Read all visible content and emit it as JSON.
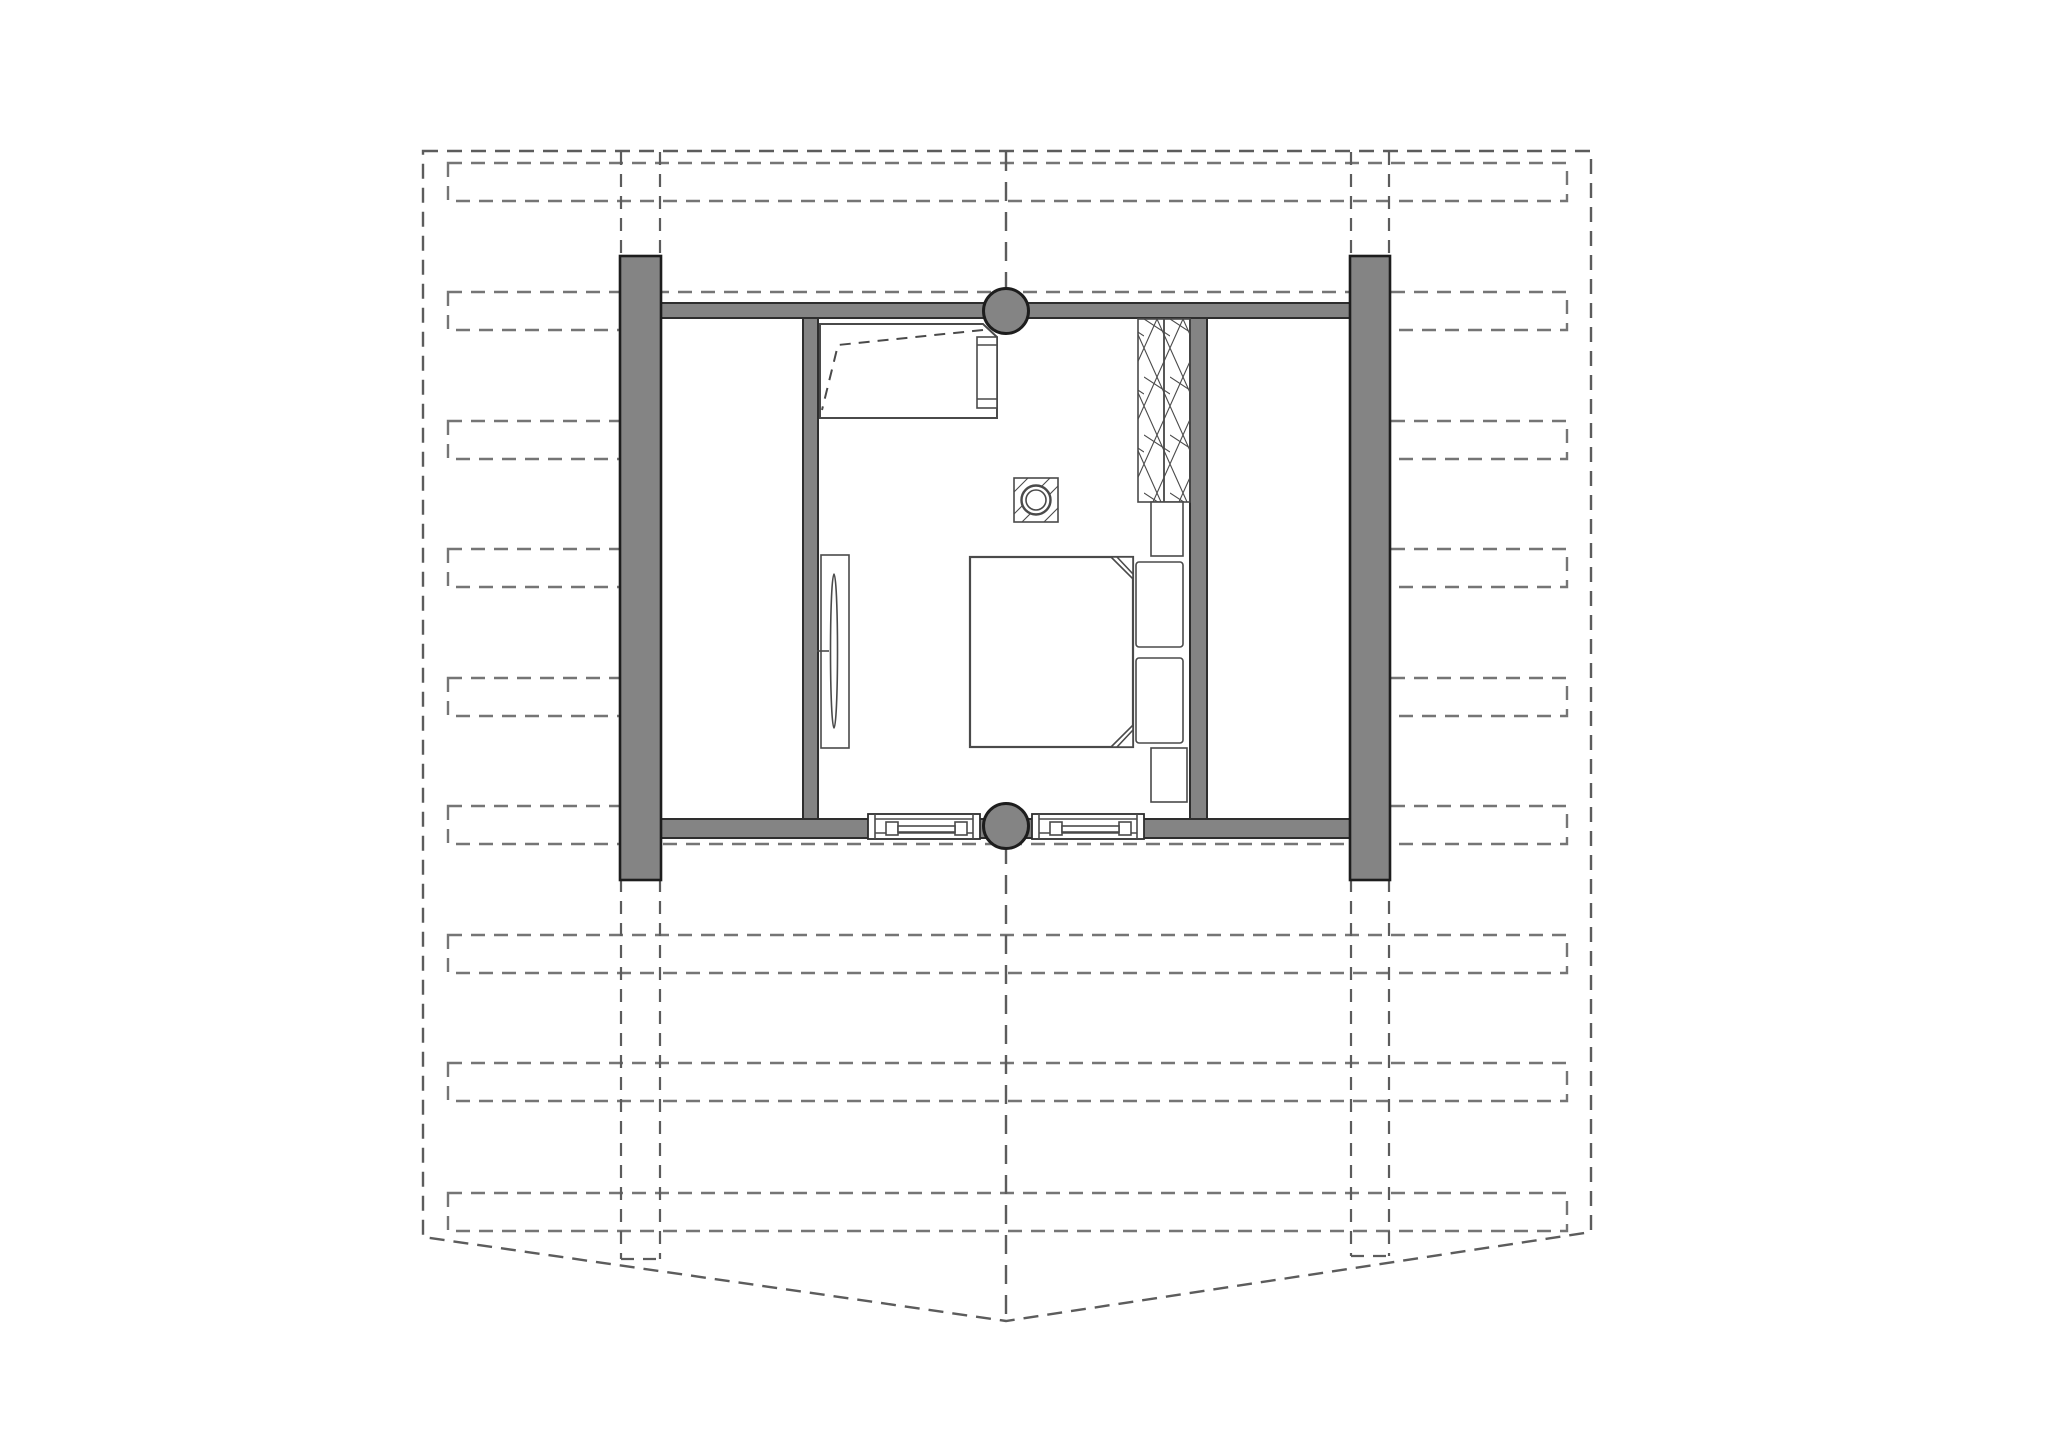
{
  "document": {
    "kind": "architectural-floor-plan",
    "description": "Attic bedroom floor plan over dashed roof-framing outline"
  },
  "palette": {
    "paper": "#ffffff",
    "wall-fill": "#848484",
    "wall-edge": "#2e2e2e",
    "post-edge": "#1d1d1d",
    "line": "#4a4a4a",
    "dash-dark": "#5c5c5c",
    "dash-light": "#757575"
  },
  "elements": [
    {
      "name": "roof-outline",
      "kind": "dashed gable boundary with ridge point at bottom center"
    },
    {
      "name": "roof-joist-bars",
      "kind": "9 dashed horizontal framing bars",
      "count": 9
    },
    {
      "name": "ridge-centerline",
      "kind": "dashed vertical center axis"
    },
    {
      "name": "left-pillar-column",
      "kind": "solid wall pier with dashed continuation"
    },
    {
      "name": "right-pillar-column",
      "kind": "solid wall pier with dashed continuation"
    },
    {
      "name": "top-round-post",
      "kind": "structural round column on top wall"
    },
    {
      "name": "bottom-round-post",
      "kind": "structural round column on bottom wall"
    },
    {
      "name": "bedroom",
      "kind": "room with double bed, two pillows, two nightstands"
    },
    {
      "name": "wardrobe",
      "kind": "double-column hatched closet unit"
    },
    {
      "name": "chimney-flue",
      "kind": "square flue with round pipe"
    },
    {
      "name": "desk-cabinet",
      "kind": "counter with dashed door swing and side rail"
    },
    {
      "name": "cheval-mirror",
      "kind": "tall leaning mirror on partition wall"
    },
    {
      "name": "window-left",
      "kind": "window in bottom wall"
    },
    {
      "name": "window-right",
      "kind": "window in bottom wall"
    }
  ]
}
